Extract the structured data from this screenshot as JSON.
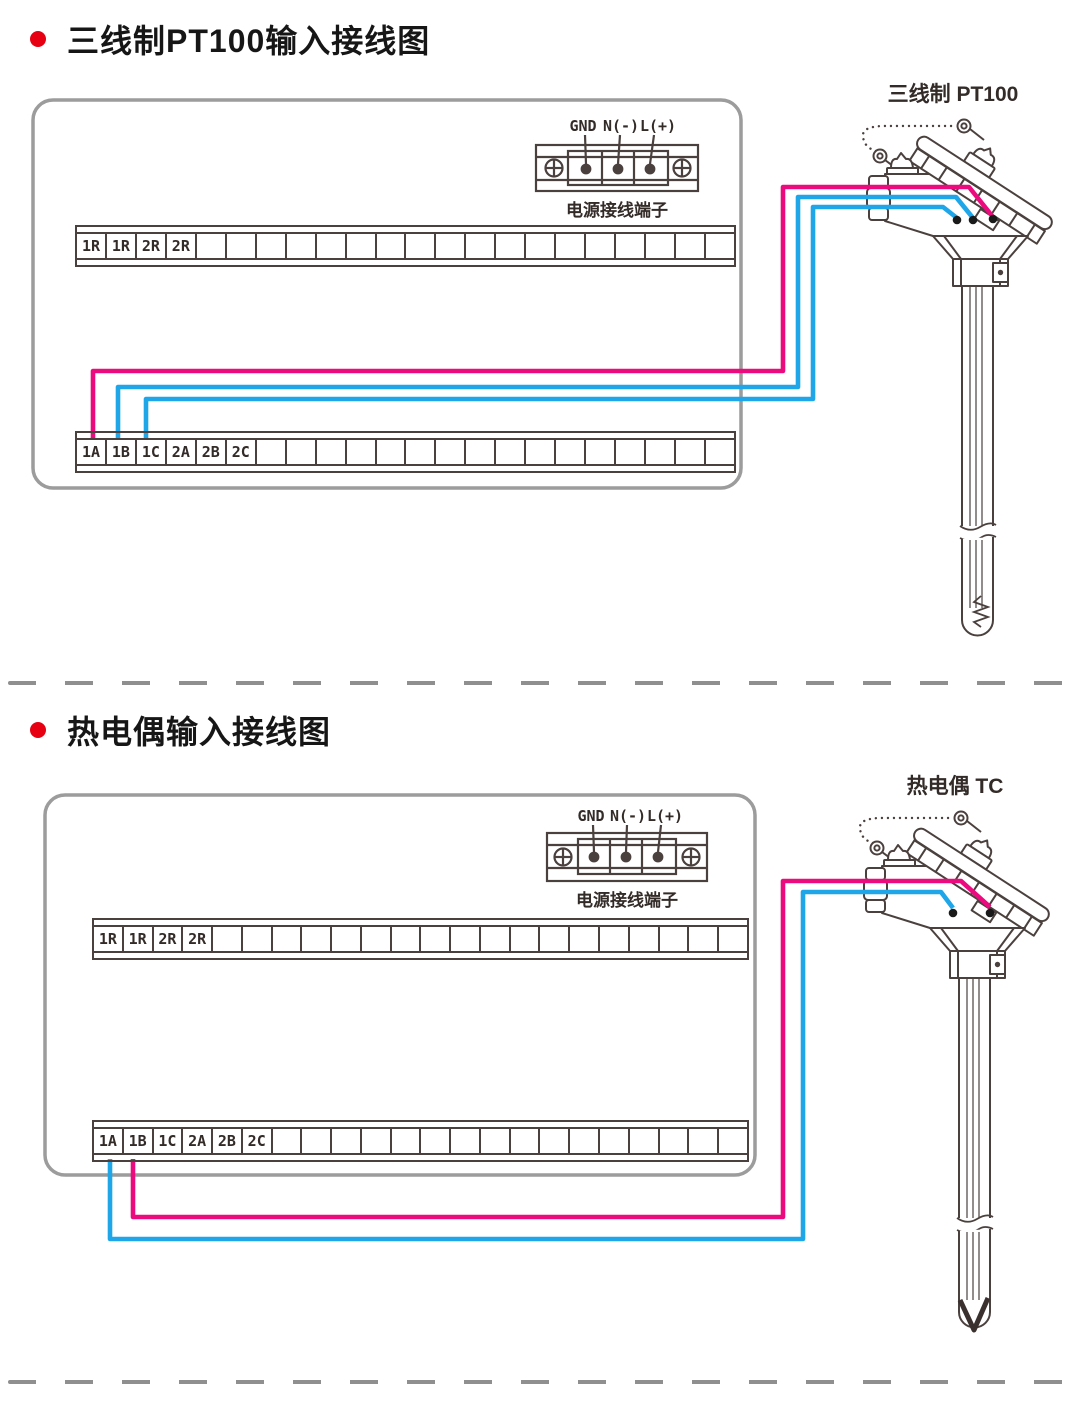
{
  "colors": {
    "bullet_red": "#e60012",
    "wire_magenta": "#ec0b7e",
    "wire_blue": "#1fa6e9",
    "line_art": "#4a403d",
    "panel_border": "#9c9c9c",
    "terminal_dot": "#1a1a1a"
  },
  "sections": [
    {
      "title": "三线制PT100输入接线图",
      "sensor_label": "三线制 PT100",
      "power_terminal": {
        "labels": [
          "GND",
          "N(-)",
          "L(+)"
        ],
        "caption": "电源接线端子"
      },
      "strip_top_cells": [
        "1R",
        "1R",
        "2R",
        "2R",
        "",
        "",
        "",
        "",
        "",
        "",
        "",
        "",
        "",
        "",
        "",
        "",
        "",
        "",
        "",
        "",
        "",
        ""
      ],
      "strip_bottom_cells": [
        "1A",
        "1B",
        "1C",
        "2A",
        "2B",
        "2C",
        "",
        "",
        "",
        "",
        "",
        "",
        "",
        "",
        "",
        "",
        "",
        "",
        "",
        "",
        "",
        ""
      ]
    },
    {
      "title": "热电偶输入接线图",
      "sensor_label": "热电偶 TC",
      "power_terminal": {
        "labels": [
          "GND",
          "N(-)",
          "L(+)"
        ],
        "caption": "电源接线端子"
      },
      "strip_top_cells": [
        "1R",
        "1R",
        "2R",
        "2R",
        "",
        "",
        "",
        "",
        "",
        "",
        "",
        "",
        "",
        "",
        "",
        "",
        "",
        "",
        "",
        "",
        "",
        ""
      ],
      "strip_bottom_cells": [
        "1A",
        "1B",
        "1C",
        "2A",
        "2B",
        "2C",
        "",
        "",
        "",
        "",
        "",
        "",
        "",
        "",
        "",
        "",
        "",
        "",
        "",
        "",
        "",
        ""
      ]
    }
  ]
}
